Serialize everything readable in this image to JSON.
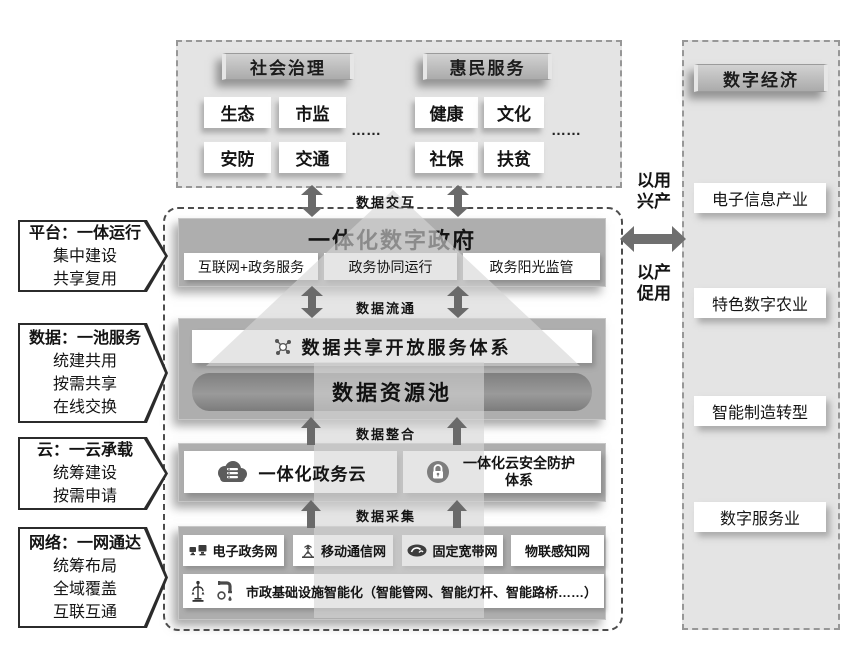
{
  "colors": {
    "panel_bg": "#e4e4e4",
    "layer_bg": "#aeaeae",
    "pool_bg": "#8a8a8a",
    "arrow": "#6a6a6a",
    "header_bar": "#bdbdbd",
    "text": "#141414",
    "white_box": "#ffffff"
  },
  "top_panel": {
    "groups": [
      {
        "title": "社会治理",
        "items": [
          "生态",
          "市监",
          "安防",
          "交通"
        ],
        "more": "……"
      },
      {
        "title": "惠民服务",
        "items": [
          "健康",
          "文化",
          "社保",
          "扶贫"
        ],
        "more": "……"
      }
    ]
  },
  "left_callouts": [
    {
      "title": "平台：一体运行",
      "lines": [
        "集中建设",
        "共享复用"
      ]
    },
    {
      "title": "数据：一池服务",
      "lines": [
        "统建共用",
        "按需共享",
        "在线交换"
      ]
    },
    {
      "title": "云：一云承载",
      "lines": [
        "统筹建设",
        "按需申请"
      ]
    },
    {
      "title": "网络：一网通达",
      "lines": [
        "统筹布局",
        "全域覆盖",
        "互联互通"
      ]
    }
  ],
  "center": {
    "flow_labels": {
      "interact": "数据交互",
      "circulate": "数据流通",
      "integrate": "数据整合",
      "collect": "数据采集"
    },
    "gov": {
      "title": "一体化数字政府",
      "items": [
        "互联网+政务服务",
        "政务协同运行",
        "政务阳光监管"
      ]
    },
    "data_layer": {
      "share_system": "数据共享开放服务体系",
      "pool": "数据资源池"
    },
    "cloud_layer": {
      "cloud": "一体化政务云",
      "security": "一体化云安全防护体系"
    },
    "network_layer": {
      "networks": [
        "电子政务网",
        "移动通信网",
        "固定宽带网",
        "物联感知网"
      ],
      "infra": "市政基础设施智能化（智能管网、智能灯杆、智能路桥……）"
    }
  },
  "bridge": {
    "top": "以用\n兴产",
    "bottom": "以产\n促用"
  },
  "right_panel": {
    "title": "数字经济",
    "items": [
      "电子信息产业",
      "特色数字农业",
      "智能制造转型",
      "数字服务业"
    ]
  }
}
